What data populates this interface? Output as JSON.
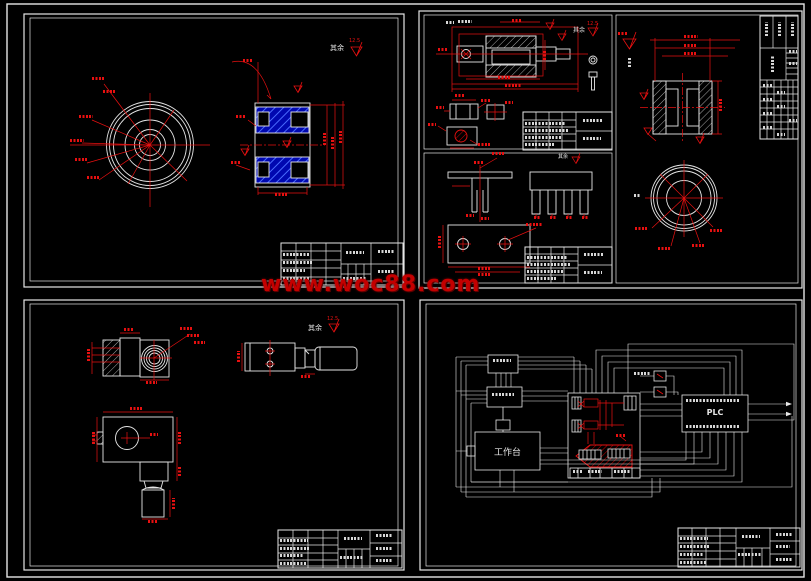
{
  "watermark": {
    "text": "www.woc88.com"
  },
  "surface_finish": {
    "note": "其余",
    "value": "12.5"
  },
  "schematic": {
    "workbench_label": "工作台",
    "plc_label": "PLC"
  },
  "colors": {
    "background": "#000000",
    "drawing_line": "#e6e6e6",
    "dimension_red": "#e81010",
    "section_hatch_blue": "#0008b0",
    "watermark_red": "#c40000"
  }
}
